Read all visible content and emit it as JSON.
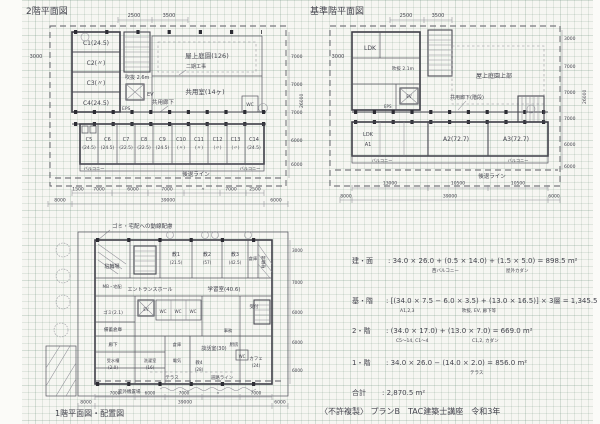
{
  "sheet": {
    "footer": "〈不許複製〉 プランB　TAC建築士講座　令和3年"
  },
  "plan2f": {
    "title": "2階平面図",
    "rooms": {
      "c1": "C1(24.5)",
      "c2": "C2(〃)",
      "c3": "C3(〃)",
      "c4": "C4(24.5)",
      "stair_note": "吹抜 2.6m",
      "ev": "EV",
      "eps": "EPS",
      "garden": "屋上庭園(126)",
      "garden_note": "二期工事",
      "common_room": "共用室(14ヶ)",
      "corridor": "共用廊下",
      "wc": "WC"
    },
    "units": [
      {
        "name": "C5",
        "area": "(24.5)"
      },
      {
        "name": "C6",
        "area": "(24.5)"
      },
      {
        "name": "C7",
        "area": "(22.5)"
      },
      {
        "name": "C8",
        "area": "(22.5)"
      },
      {
        "name": "C9",
        "area": "(24.5)"
      },
      {
        "name": "C10",
        "area": "(〃)"
      },
      {
        "name": "C11",
        "area": "(〃)"
      },
      {
        "name": "C12",
        "area": "(〃)"
      },
      {
        "name": "C13",
        "area": "(〃)"
      },
      {
        "name": "C14",
        "area": "(24.5)"
      }
    ],
    "balcony_left": "バルコニー",
    "balcony_right": "バルコニー",
    "setback": "後退ライン",
    "dims": {
      "top1": "2500",
      "top2": "3500",
      "left": "3000",
      "bottom": [
        "1500",
        "7000",
        "6000",
        "7000",
        "〃",
        "7000",
        "2500"
      ],
      "totals": [
        "8000",
        "39000",
        "6000"
      ],
      "right": [
        "7000",
        "7000",
        "7000",
        "6000",
        "6000"
      ],
      "right_total": "26000"
    }
  },
  "planstd": {
    "title": "基準階平面図",
    "rooms": {
      "ldk": "LDK",
      "stair_note": "吹抜 2.1m",
      "ev": "EV",
      "eps": "EPS",
      "roof": "屋上庭園上部",
      "corridor": "共用廊下(階段)",
      "a1_type": "LDK",
      "a1": "A1",
      "a2": "A2(72.7)",
      "a3": "A3(72.7)"
    },
    "balcony_left": "バルコニー",
    "balcony_right": "バルコニー",
    "setback": "後退ライン",
    "dims": {
      "top1": "2500",
      "top2": "3500",
      "left": "3000",
      "bottom": [
        "13000",
        "10500",
        "10500"
      ],
      "totals": [
        "8000",
        "39000",
        "6000"
      ],
      "right": [
        "3000",
        "7000",
        "7000",
        "7000",
        "6000",
        "6000"
      ],
      "right_total": "26000"
    }
  },
  "plan1f": {
    "title": "1階平面図・配置図",
    "note": "ゴミ・宅配への動線配慮",
    "rooms": {
      "bike1": "駐輪場",
      "mb": "MB・宅配",
      "wind": "風除室",
      "entrance": "エントランスホール",
      "k1": "教1",
      "k1a": "(21.5)",
      "k2": "教2",
      "k2a": "(57)",
      "k3": "教3",
      "k3a": "(42.5)",
      "soko1": "倉庫",
      "bike2": "駐輪場",
      "study": "学習室(40.6)",
      "wc1": "WC",
      "wc2": "WC",
      "wc3": "WC",
      "ev": "EV",
      "gomi": "ゴミ(2.1)",
      "bichiku": "備蓄倉庫",
      "roka": "廊下",
      "jusui": "受水槽",
      "jusuia": "(2.0)",
      "sentaku": "洗濯室",
      "sentakua": "(16)",
      "denki": "電気",
      "soko2": "倉庫",
      "danwa": "談話室(30)",
      "k4": "教4",
      "k4a": "(28)",
      "jimu": "事務",
      "uketsuke": "受付",
      "chubo": "厨房",
      "wc4": "WC",
      "cafe": "カフェ",
      "cafea": "(24)",
      "terrace": "テラス",
      "outdoor": "室外機置場",
      "road": "道路ライン"
    },
    "dims": {
      "bottom": [
        "7000",
        "6000",
        "7000",
        "〃",
        "7000"
      ],
      "totals": [
        "8000",
        "39000",
        "6000"
      ],
      "right": [
        "3000",
        "7000",
        "6000",
        "6000",
        "6000"
      ]
    }
  },
  "calc": {
    "lines": [
      {
        "head": "建・面",
        "body": ":  34.0 × 26.0 + (0.5 × 14.0) + (1.5 × 5.0)  =  898.5 m²",
        "sub1": "西バルコニー",
        "sub2": "屋外カダン"
      },
      {
        "head": "基・階",
        "body": ": [(34.0 × 7.5 − 6.0 × 3.5) + (13.0 × 16.5)] × 3層 = 1,345.5 m²",
        "sub1": "A1,2,3",
        "sub2": "吹抜, EV, 廊下等"
      },
      {
        "head": "2・階",
        "body": ":  (34.0 × 17.0) + (13.0 × 7.0)  =  669.0 m²",
        "sub1": "C5〜14, C1〜4",
        "sub2": "C1,2, カダン"
      },
      {
        "head": "1・階",
        "body": ":  34.0 × 26.0 − (14.0 × 2.0)  =  856.0 m²",
        "sub1": "テラス"
      },
      {
        "head": "合計",
        "body": ":  2,870.5 m²"
      }
    ]
  }
}
